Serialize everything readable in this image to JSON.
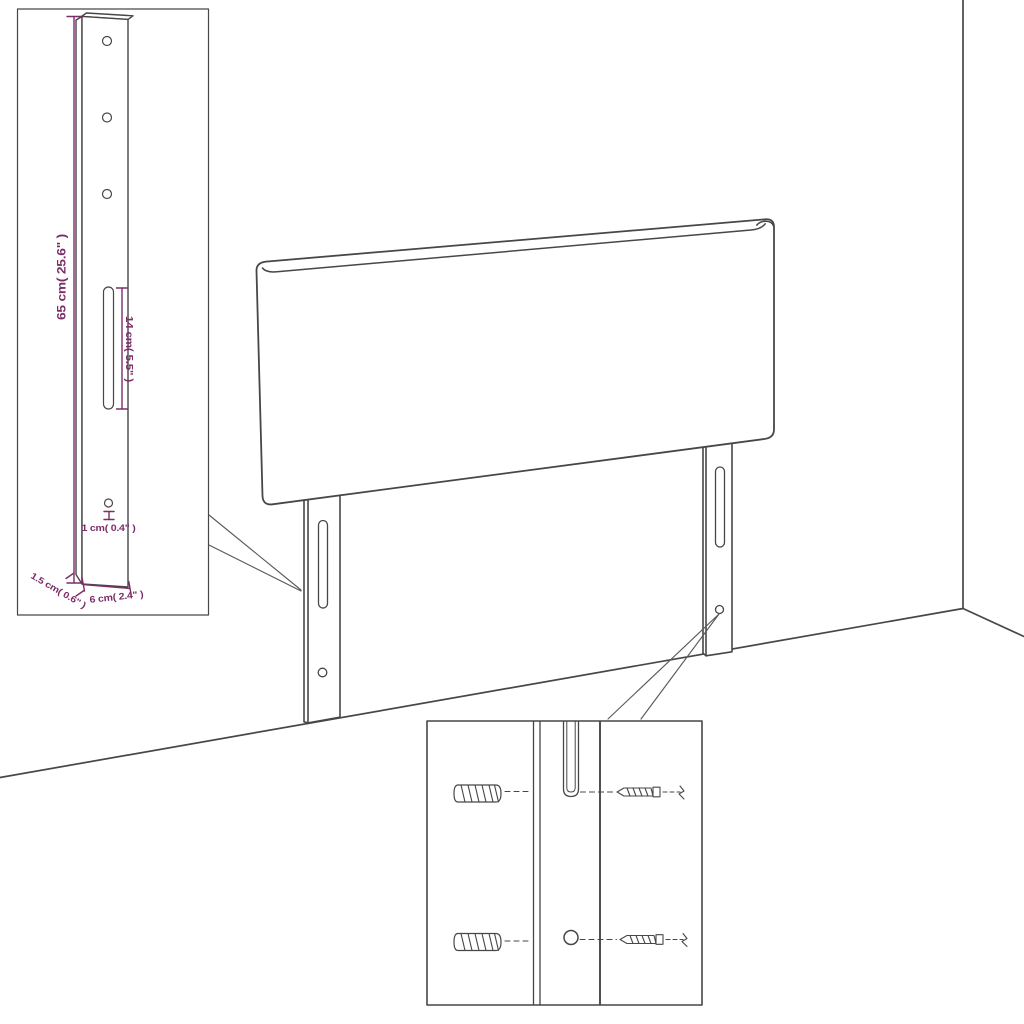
{
  "dimension_labels": {
    "leg_height": "65 cm( 25.6\" )",
    "slot_length": "14 cm( 5.5\" )",
    "hole_diameter": "1 cm( 0.4\" )",
    "bottom_thickness": "1.5 cm( 0.6\" )",
    "leg_width": "6 cm( 2.4\" )"
  },
  "colors": {
    "outline": "#474747",
    "dimension": "#7c2d69",
    "callout": "#5a5a5a",
    "background": "#ffffff"
  }
}
